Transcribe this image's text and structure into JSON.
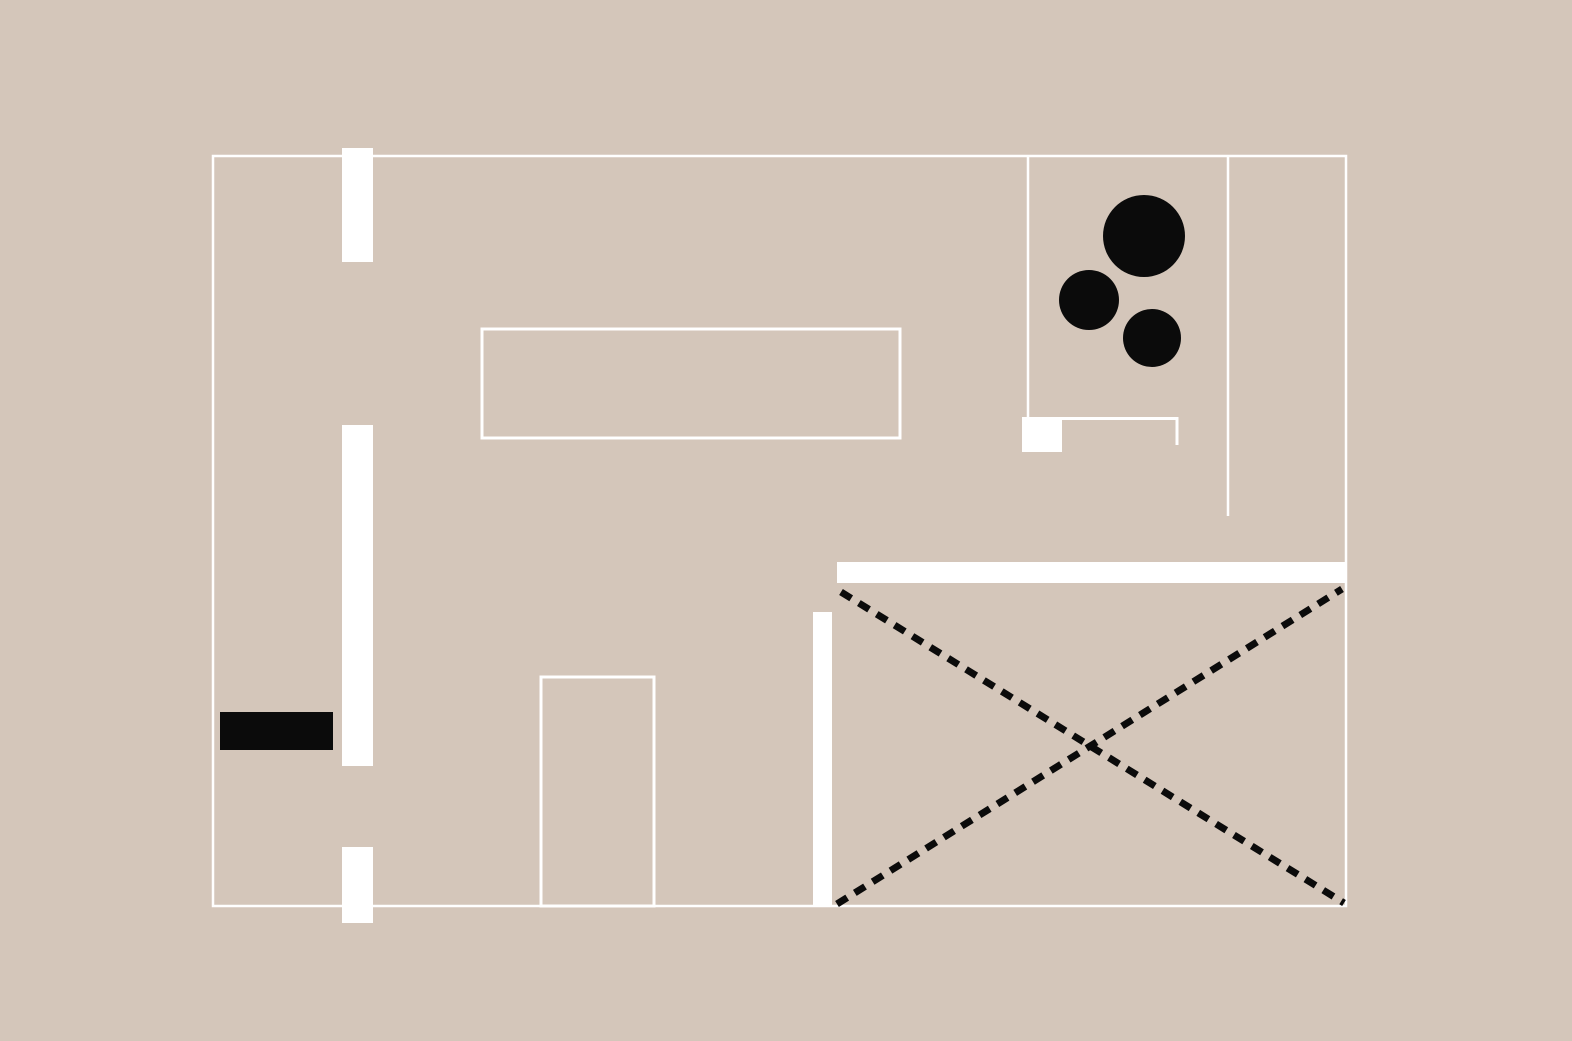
{
  "canvas": {
    "width": 1572,
    "height": 1041,
    "viewbox": "0 0 1572 1041",
    "background": "#d4c6ba"
  },
  "palette": {
    "background_beige": "#d4c6ba",
    "wall_white": "#ffffff",
    "ink_black": "#0b0b0b"
  },
  "diagram": {
    "kind": "abstract-architectural-floor-plan",
    "title": "",
    "text_labels": []
  },
  "shapes": [
    {
      "name": "outer-wall-boundary",
      "tag": "rect",
      "attrs": {
        "x": 213,
        "y": 156,
        "width": 1133,
        "height": 750,
        "fill": "none",
        "stroke": "#ffffff",
        "stroke-width": 2.5
      }
    },
    {
      "name": "pillar-wall-top-left",
      "tag": "rect",
      "attrs": {
        "x": 342,
        "y": 148,
        "width": 31,
        "height": 114,
        "fill": "#ffffff"
      }
    },
    {
      "name": "pillar-wall-middle-left",
      "tag": "rect",
      "attrs": {
        "x": 342,
        "y": 425,
        "width": 31,
        "height": 341,
        "fill": "#ffffff"
      }
    },
    {
      "name": "pillar-wall-bottom-left",
      "tag": "rect",
      "attrs": {
        "x": 342,
        "y": 847,
        "width": 31,
        "height": 76,
        "fill": "#ffffff"
      }
    },
    {
      "name": "black-fixture-rect",
      "tag": "rect",
      "attrs": {
        "x": 220,
        "y": 712,
        "width": 113,
        "height": 38,
        "fill": "#0b0b0b"
      }
    },
    {
      "name": "table-outline-rect",
      "tag": "rect",
      "attrs": {
        "x": 482,
        "y": 329,
        "width": 418,
        "height": 109,
        "fill": "none",
        "stroke": "#ffffff",
        "stroke-width": 3
      }
    },
    {
      "name": "doorway-outline-rect",
      "tag": "rect",
      "attrs": {
        "x": 541,
        "y": 677,
        "width": 113,
        "height": 229,
        "fill": "none",
        "stroke": "#ffffff",
        "stroke-width": 3
      }
    },
    {
      "name": "partition-wall-vertical",
      "tag": "rect",
      "attrs": {
        "x": 813,
        "y": 612,
        "width": 19,
        "height": 295,
        "fill": "#ffffff"
      }
    },
    {
      "name": "partition-wall-thick-horizontal",
      "tag": "rect",
      "attrs": {
        "x": 837,
        "y": 562,
        "width": 508,
        "height": 21,
        "fill": "#ffffff"
      }
    },
    {
      "name": "room-divider-line-left",
      "tag": "line",
      "attrs": {
        "x1": 1028,
        "y1": 156,
        "x2": 1028,
        "y2": 417,
        "stroke": "#ffffff",
        "stroke-width": 2.5
      }
    },
    {
      "name": "fixture-square-white",
      "tag": "rect",
      "attrs": {
        "x": 1022,
        "y": 417,
        "width": 40,
        "height": 35,
        "fill": "#ffffff"
      }
    },
    {
      "name": "counter-outline-l-shape",
      "tag": "path",
      "attrs": {
        "d": "M 1062 418.5 H 1177 V 445",
        "fill": "none",
        "stroke": "#ffffff",
        "stroke-width": 3
      }
    },
    {
      "name": "room-divider-line-right",
      "tag": "line",
      "attrs": {
        "x1": 1228,
        "y1": 156,
        "x2": 1228,
        "y2": 516,
        "stroke": "#ffffff",
        "stroke-width": 2.5
      }
    },
    {
      "name": "furniture-circle-large",
      "tag": "circle",
      "attrs": {
        "cx": 1144,
        "cy": 236,
        "r": 41,
        "fill": "#0b0b0b"
      }
    },
    {
      "name": "furniture-circle-medium",
      "tag": "circle",
      "attrs": {
        "cx": 1089,
        "cy": 300,
        "r": 30,
        "fill": "#0b0b0b"
      }
    },
    {
      "name": "furniture-circle-small",
      "tag": "circle",
      "attrs": {
        "cx": 1152,
        "cy": 338,
        "r": 29,
        "fill": "#0b0b0b"
      }
    },
    {
      "name": "dashed-cross-diagonal-down",
      "tag": "line",
      "attrs": {
        "x1": 841,
        "y1": 592,
        "x2": 1344,
        "y2": 903,
        "stroke": "#0b0b0b",
        "stroke-width": 7,
        "stroke-dasharray": "12 9"
      }
    },
    {
      "name": "dashed-cross-diagonal-up",
      "tag": "line",
      "attrs": {
        "x1": 837,
        "y1": 904,
        "x2": 1342,
        "y2": 589,
        "stroke": "#0b0b0b",
        "stroke-width": 7,
        "stroke-dasharray": "12 9"
      }
    }
  ]
}
